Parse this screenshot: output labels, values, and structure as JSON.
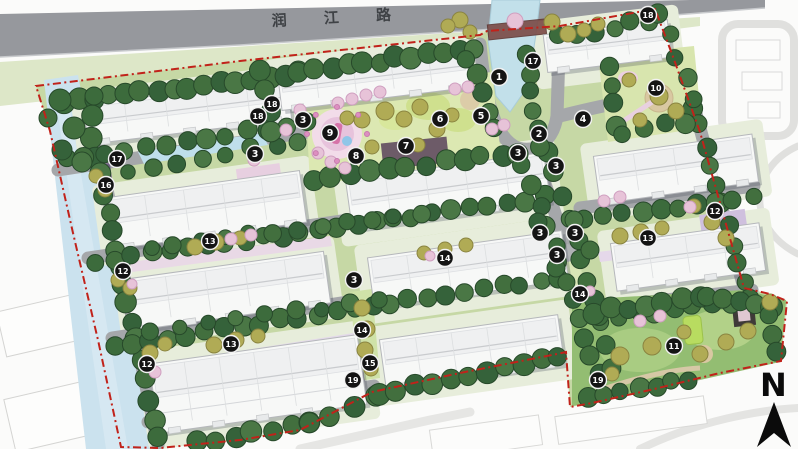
{
  "plan": {
    "title": "residential-master-plan",
    "road": {
      "label": "润 江 路"
    },
    "compass": {
      "label": "N"
    },
    "colors": {
      "boundary_red": "#c1221a",
      "road_gray": "#96989d",
      "inner_road_gray": "#a5a7aa",
      "site_green": "#c6d8a5",
      "tree_dark_green": "#3c6b3c",
      "tree_olive": "#b0ab55",
      "tree_pink": "#e7c3d8",
      "water_blue": "#c5e0ec",
      "building_white": "#f7f8f7",
      "marker_black": "#141414"
    },
    "markers": [
      {
        "n": "1",
        "x": 499,
        "y": 77
      },
      {
        "n": "2",
        "x": 539,
        "y": 134
      },
      {
        "n": "3",
        "x": 303,
        "y": 120
      },
      {
        "n": "3",
        "x": 255,
        "y": 154
      },
      {
        "n": "3",
        "x": 518,
        "y": 153
      },
      {
        "n": "3",
        "x": 556,
        "y": 166
      },
      {
        "n": "3",
        "x": 540,
        "y": 233
      },
      {
        "n": "3",
        "x": 575,
        "y": 233
      },
      {
        "n": "3",
        "x": 557,
        "y": 255
      },
      {
        "n": "3",
        "x": 354,
        "y": 280
      },
      {
        "n": "4",
        "x": 583,
        "y": 119
      },
      {
        "n": "5",
        "x": 481,
        "y": 116
      },
      {
        "n": "6",
        "x": 440,
        "y": 119
      },
      {
        "n": "7",
        "x": 406,
        "y": 146
      },
      {
        "n": "8",
        "x": 356,
        "y": 156
      },
      {
        "n": "9",
        "x": 330,
        "y": 133
      },
      {
        "n": "10",
        "x": 656,
        "y": 88
      },
      {
        "n": "11",
        "x": 674,
        "y": 346
      },
      {
        "n": "12",
        "x": 715,
        "y": 211
      },
      {
        "n": "12",
        "x": 123,
        "y": 271
      },
      {
        "n": "12",
        "x": 147,
        "y": 364
      },
      {
        "n": "13",
        "x": 210,
        "y": 241
      },
      {
        "n": "13",
        "x": 231,
        "y": 344
      },
      {
        "n": "13",
        "x": 648,
        "y": 238
      },
      {
        "n": "14",
        "x": 445,
        "y": 258
      },
      {
        "n": "14",
        "x": 580,
        "y": 294
      },
      {
        "n": "14",
        "x": 362,
        "y": 330
      },
      {
        "n": "15",
        "x": 370,
        "y": 363
      },
      {
        "n": "16",
        "x": 106,
        "y": 185
      },
      {
        "n": "17",
        "x": 533,
        "y": 61
      },
      {
        "n": "17",
        "x": 117,
        "y": 159
      },
      {
        "n": "18",
        "x": 648,
        "y": 15
      },
      {
        "n": "18",
        "x": 272,
        "y": 104
      },
      {
        "n": "18",
        "x": 258,
        "y": 116
      },
      {
        "n": "19",
        "x": 598,
        "y": 380
      },
      {
        "n": "19",
        "x": 353,
        "y": 380
      }
    ]
  }
}
